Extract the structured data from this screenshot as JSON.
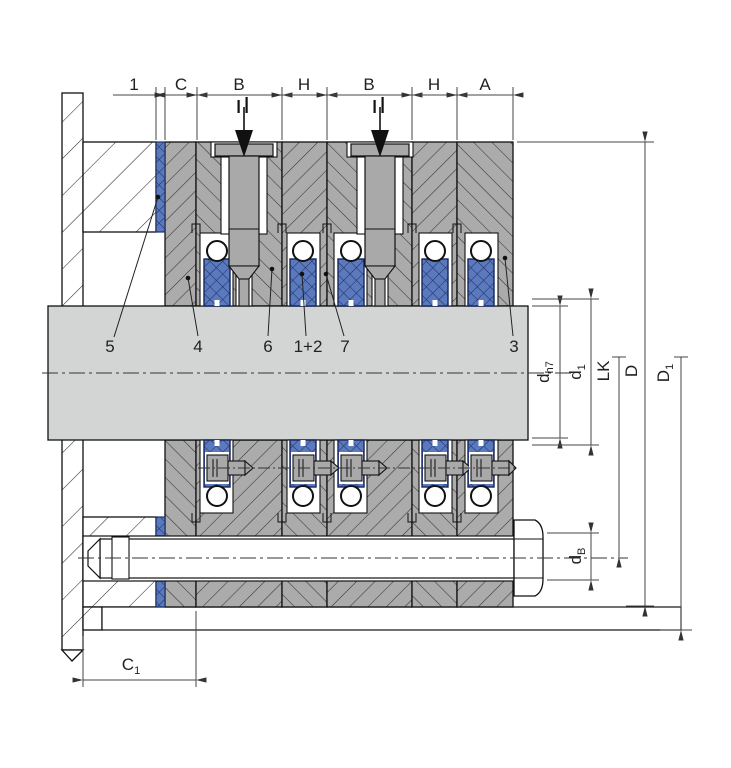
{
  "dims_top": {
    "seg1": "1",
    "segC": "C",
    "segB1": "B",
    "segH1": "H",
    "segB2": "B",
    "segH2": "H",
    "segA": "A"
  },
  "dims_right": {
    "dh7_base": "d",
    "dh7_sub": "h7",
    "d1_base": "d",
    "d1_sub": "1",
    "lk": "LK",
    "D": "D",
    "D1_base": "D",
    "D1_sub": "1",
    "db_base": "d",
    "db_sub": "B"
  },
  "dims_bottom": {
    "c1_base": "C",
    "c1_sub": "1"
  },
  "part_labels": {
    "p5": "5",
    "p4": "4",
    "p6": "6",
    "p1_2": "1+2",
    "p7": "7",
    "p3": "3"
  },
  "colors": {
    "housing_gray": "#ababab",
    "shaft_gray": "#d3d5d4",
    "packing_blue": "#5b79bd",
    "packing_line_blue": "#1e3266",
    "outline": "#111111",
    "dimension_line": "#444444"
  },
  "icons": {
    "flush_port_arrow": "filled-down-triangle",
    "flush_port_ticks": "double-vertical-tick"
  }
}
